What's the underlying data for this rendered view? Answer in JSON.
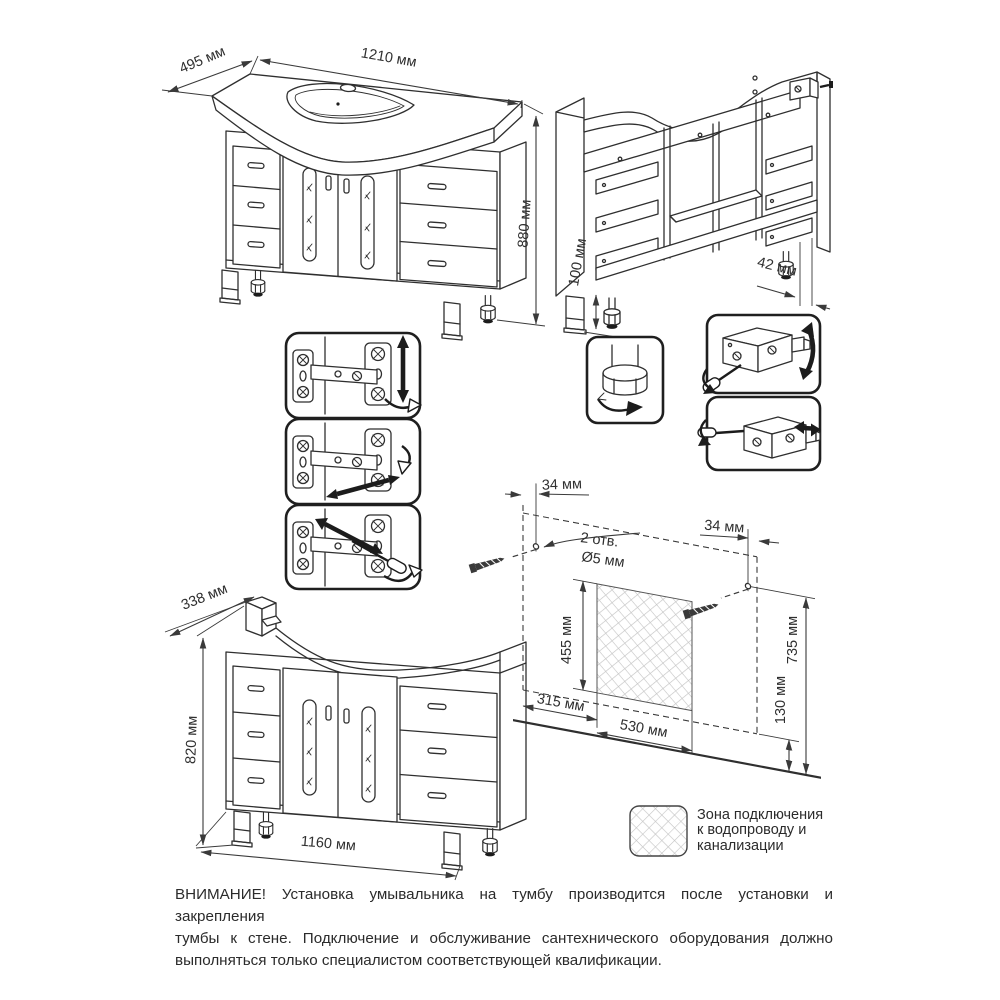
{
  "document": {
    "type": "furniture-installation-diagram",
    "language": "ru"
  },
  "views": {
    "front_with_sink": {
      "depth": "495 мм",
      "width": "1210 мм",
      "height": "880 мм"
    },
    "rear": {
      "leg_height": "100 мм",
      "wall_gap": "42 мм"
    },
    "front_cabinet": {
      "depth": "338 мм",
      "height": "820 мм",
      "width": "1160 мм"
    }
  },
  "wall_mount": {
    "left_hole_offset": "34 мм",
    "right_hole_offset": "34 мм",
    "holes_count": "2 отв.",
    "holes_diameter": "Ø5 мм",
    "zone_height": "455 мм",
    "holes_height": "735 мм",
    "zone_bottom_height": "130 мм",
    "zone_left_offset": "315 мм",
    "zone_width": "530 мм"
  },
  "legend": {
    "lines": [
      "Зона подключения",
      "к водопроводу и",
      "канализации"
    ]
  },
  "warning": {
    "lines": [
      "ВНИМАНИЕ! Установка умывальника на тумбу производится после установки и закрепления",
      "тумбы к стене. Подключение и обслуживание сантехнического оборудования должно",
      "выполняться только специалистом соответствующей квалификации."
    ]
  },
  "colors": {
    "line": "#2f2f2f",
    "text": "#2b2b2b",
    "hatch_line": "#c4c4c4"
  }
}
